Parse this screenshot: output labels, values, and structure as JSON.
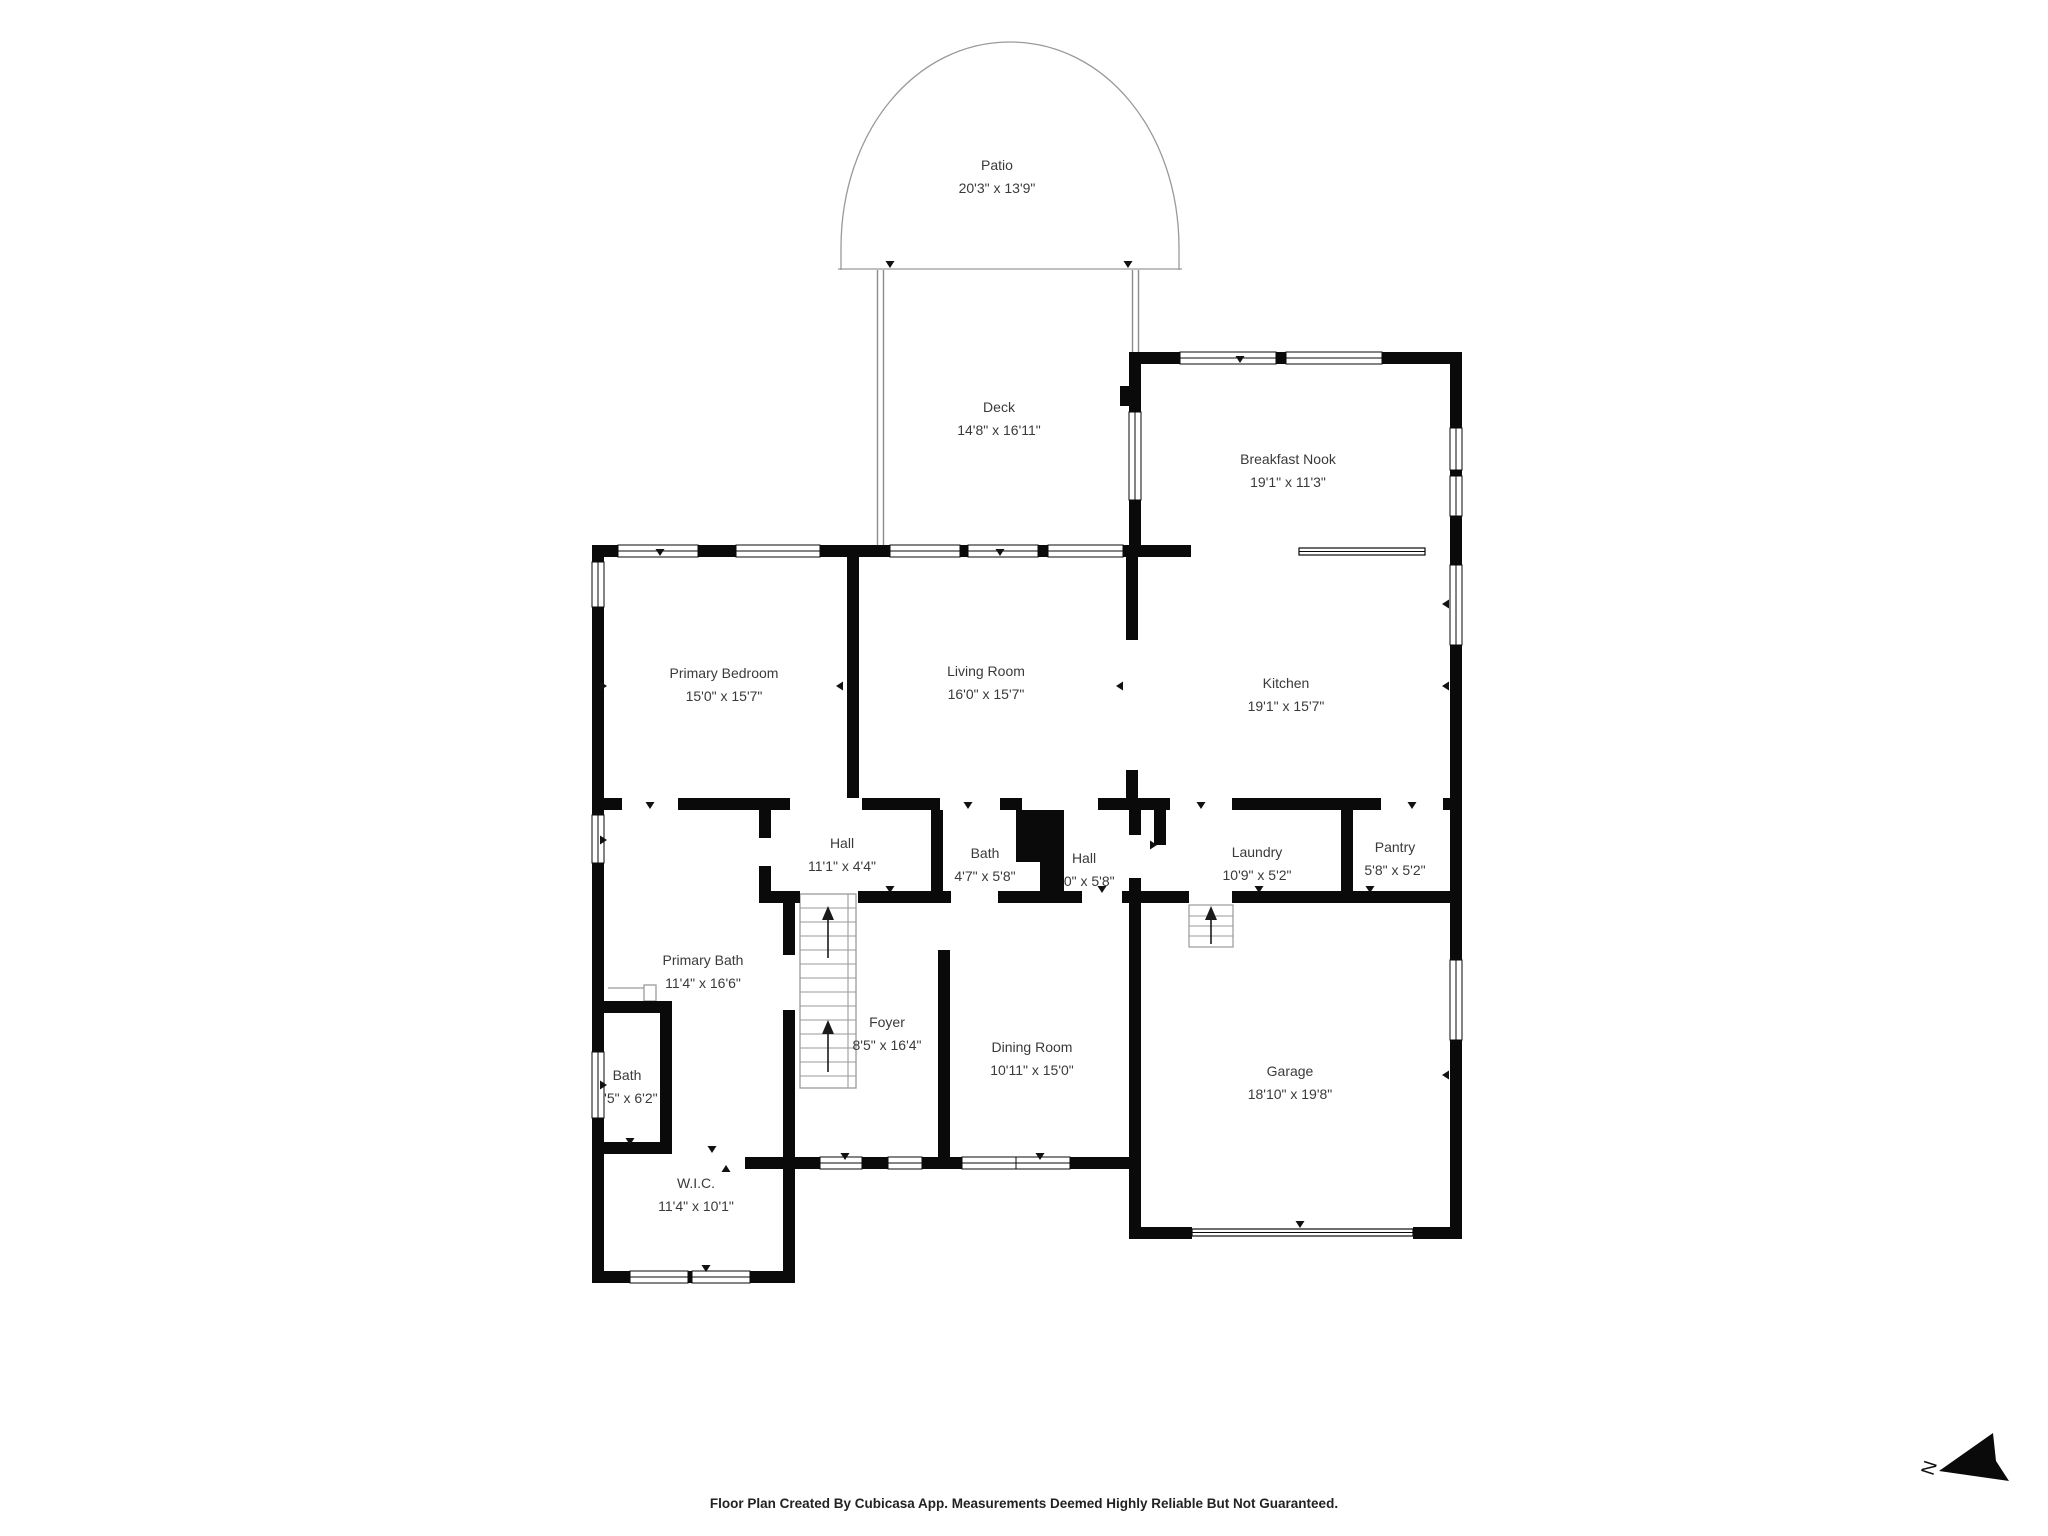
{
  "title": "Floor Plan",
  "colors": {
    "wall": "#0a0a0a",
    "text": "#3a3a3a",
    "thin_line": "#9a9a9a"
  },
  "rooms": [
    {
      "id": "patio",
      "name": "Patio",
      "dims": "20'3\" x 13'9\""
    },
    {
      "id": "deck",
      "name": "Deck",
      "dims": "14'8\" x 16'11\""
    },
    {
      "id": "breakfast-nook",
      "name": "Breakfast Nook",
      "dims": "19'1\" x 11'3\""
    },
    {
      "id": "kitchen",
      "name": "Kitchen",
      "dims": "19'1\" x 15'7\""
    },
    {
      "id": "living-room",
      "name": "Living Room",
      "dims": "16'0\" x 15'7\""
    },
    {
      "id": "primary-bedroom",
      "name": "Primary Bedroom",
      "dims": "15'0\" x 15'7\""
    },
    {
      "id": "hall",
      "name": "Hall",
      "dims": "11'1\" x 4'4\""
    },
    {
      "id": "bath",
      "name": "Bath",
      "dims": "4'7\" x 5'8\""
    },
    {
      "id": "hall-2",
      "name": "Hall",
      "dims": "6'0\" x 5'8\""
    },
    {
      "id": "laundry",
      "name": "Laundry",
      "dims": "10'9\" x 5'2\""
    },
    {
      "id": "pantry",
      "name": "Pantry",
      "dims": "5'8\" x 5'2\""
    },
    {
      "id": "primary-bath",
      "name": "Primary Bath",
      "dims": "11'4\" x 16'6\""
    },
    {
      "id": "bath-2",
      "name": "Bath",
      "dims": "3'5\" x 6'2\""
    },
    {
      "id": "foyer",
      "name": "Foyer",
      "dims": "8'5\" x 16'4\""
    },
    {
      "id": "dining-room",
      "name": "Dining Room",
      "dims": "10'11\" x 15'0\""
    },
    {
      "id": "garage",
      "name": "Garage",
      "dims": "18'10\" x 19'8\""
    },
    {
      "id": "wic",
      "name": "W.I.C.",
      "dims": "11'4\" x 10'1\""
    }
  ],
  "compass": {
    "label": "N"
  },
  "footer": {
    "text": "Floor Plan Created By Cubicasa App. Measurements Deemed Highly Reliable But Not Guaranteed."
  }
}
